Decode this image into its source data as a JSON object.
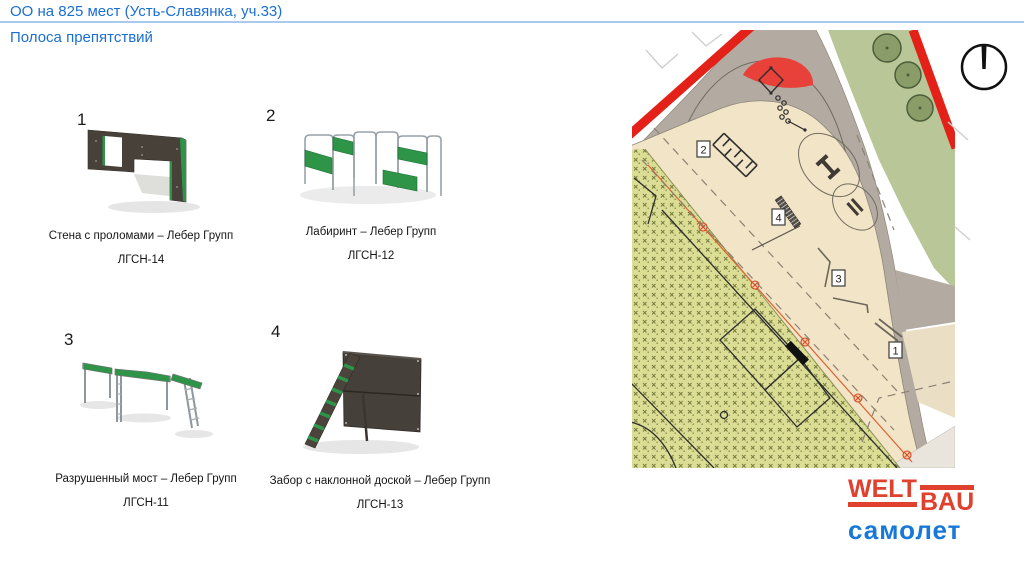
{
  "header": {
    "title": "ОО на 825 мест (Усть-Славянка, уч.33)",
    "subtitle": "Полоса препятствий"
  },
  "colors": {
    "accent_blue": "#1a6fd5",
    "divider_blue": "#a9c9ee",
    "equipment_green": "#2e9447",
    "boundary_red": "#e32119",
    "map_grass_green": "#b9c697",
    "map_sand_beige": "#f2e4c6",
    "map_grey": "#b3aba1",
    "map_hatch_lawn": "#dcdd94",
    "utility_orange": "#e0602f",
    "logo_red": "#e0402e",
    "logo_blue": "#1878d8"
  },
  "items": [
    {
      "number": "1",
      "name": "Стена с проломами – Лебер Групп",
      "code": "ЛГСН-14"
    },
    {
      "number": "2",
      "name": "Лабиринт – Лебер Групп",
      "code": "ЛГСН-12"
    },
    {
      "number": "3",
      "name": "Разрушенный мост – Лебер Групп",
      "code": "ЛГСН-11"
    },
    {
      "number": "4",
      "name": "Забор с наклонной доской – Лебер Групп",
      "code": "ЛГСН-13"
    }
  ],
  "map": {
    "markers": [
      {
        "label": "1"
      },
      {
        "label": "2"
      },
      {
        "label": "3"
      },
      {
        "label": "4"
      }
    ]
  },
  "logo": {
    "part1": "WELT",
    "part2": "BAU",
    "line2": "самолет"
  }
}
